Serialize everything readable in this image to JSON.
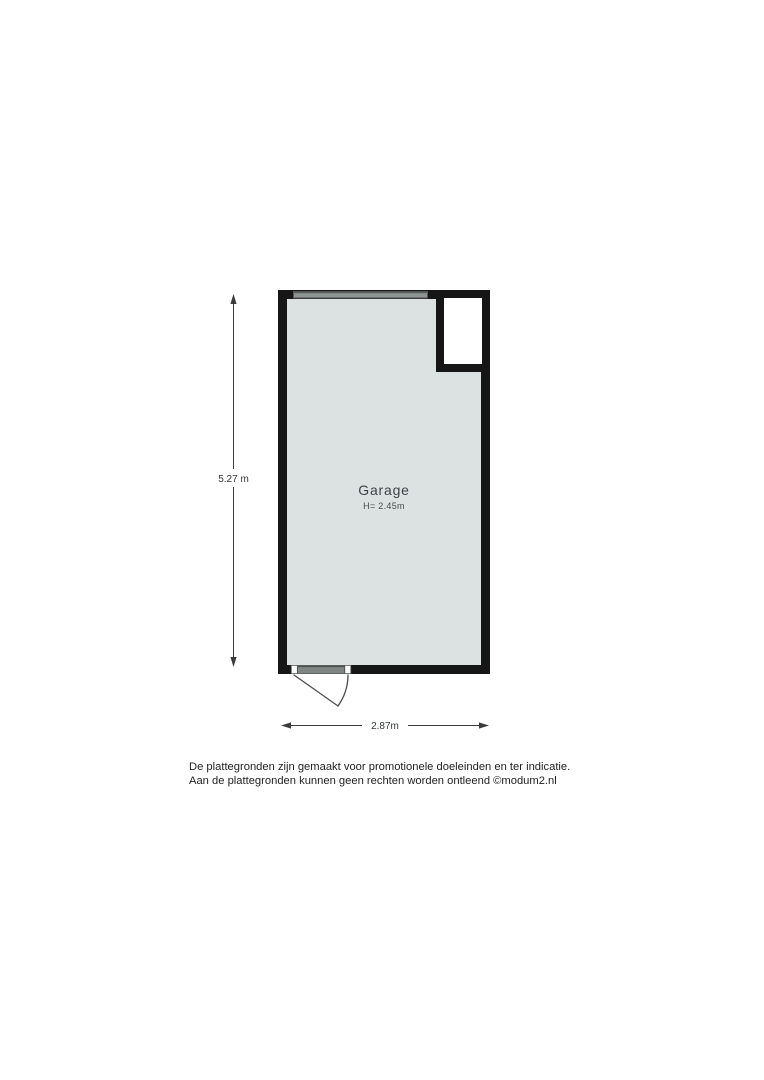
{
  "floorplan": {
    "room": {
      "name": "Garage",
      "height_label": "H= 2.45m"
    },
    "dimensions": {
      "vertical": "5.27 m",
      "horizontal": "2.87m"
    },
    "disclaimer": {
      "line1": "De plattegronden zijn gemaakt voor promotionele doeleinden en ter indicatie.",
      "line2": "Aan de plattegronden kunnen geen rechten worden ontleend ©modum2.nl"
    },
    "colors": {
      "background": "#ffffff",
      "wall": "#161616",
      "room_fill": "#dce1e2",
      "garage_door": "#8e9492",
      "garage_door_edge": "#55595a",
      "door_panel": "#7f8583",
      "dimension_line": "#3c3c3c",
      "label_text": "#3e4445",
      "disclaimer_text": "#1f1f1f"
    }
  }
}
